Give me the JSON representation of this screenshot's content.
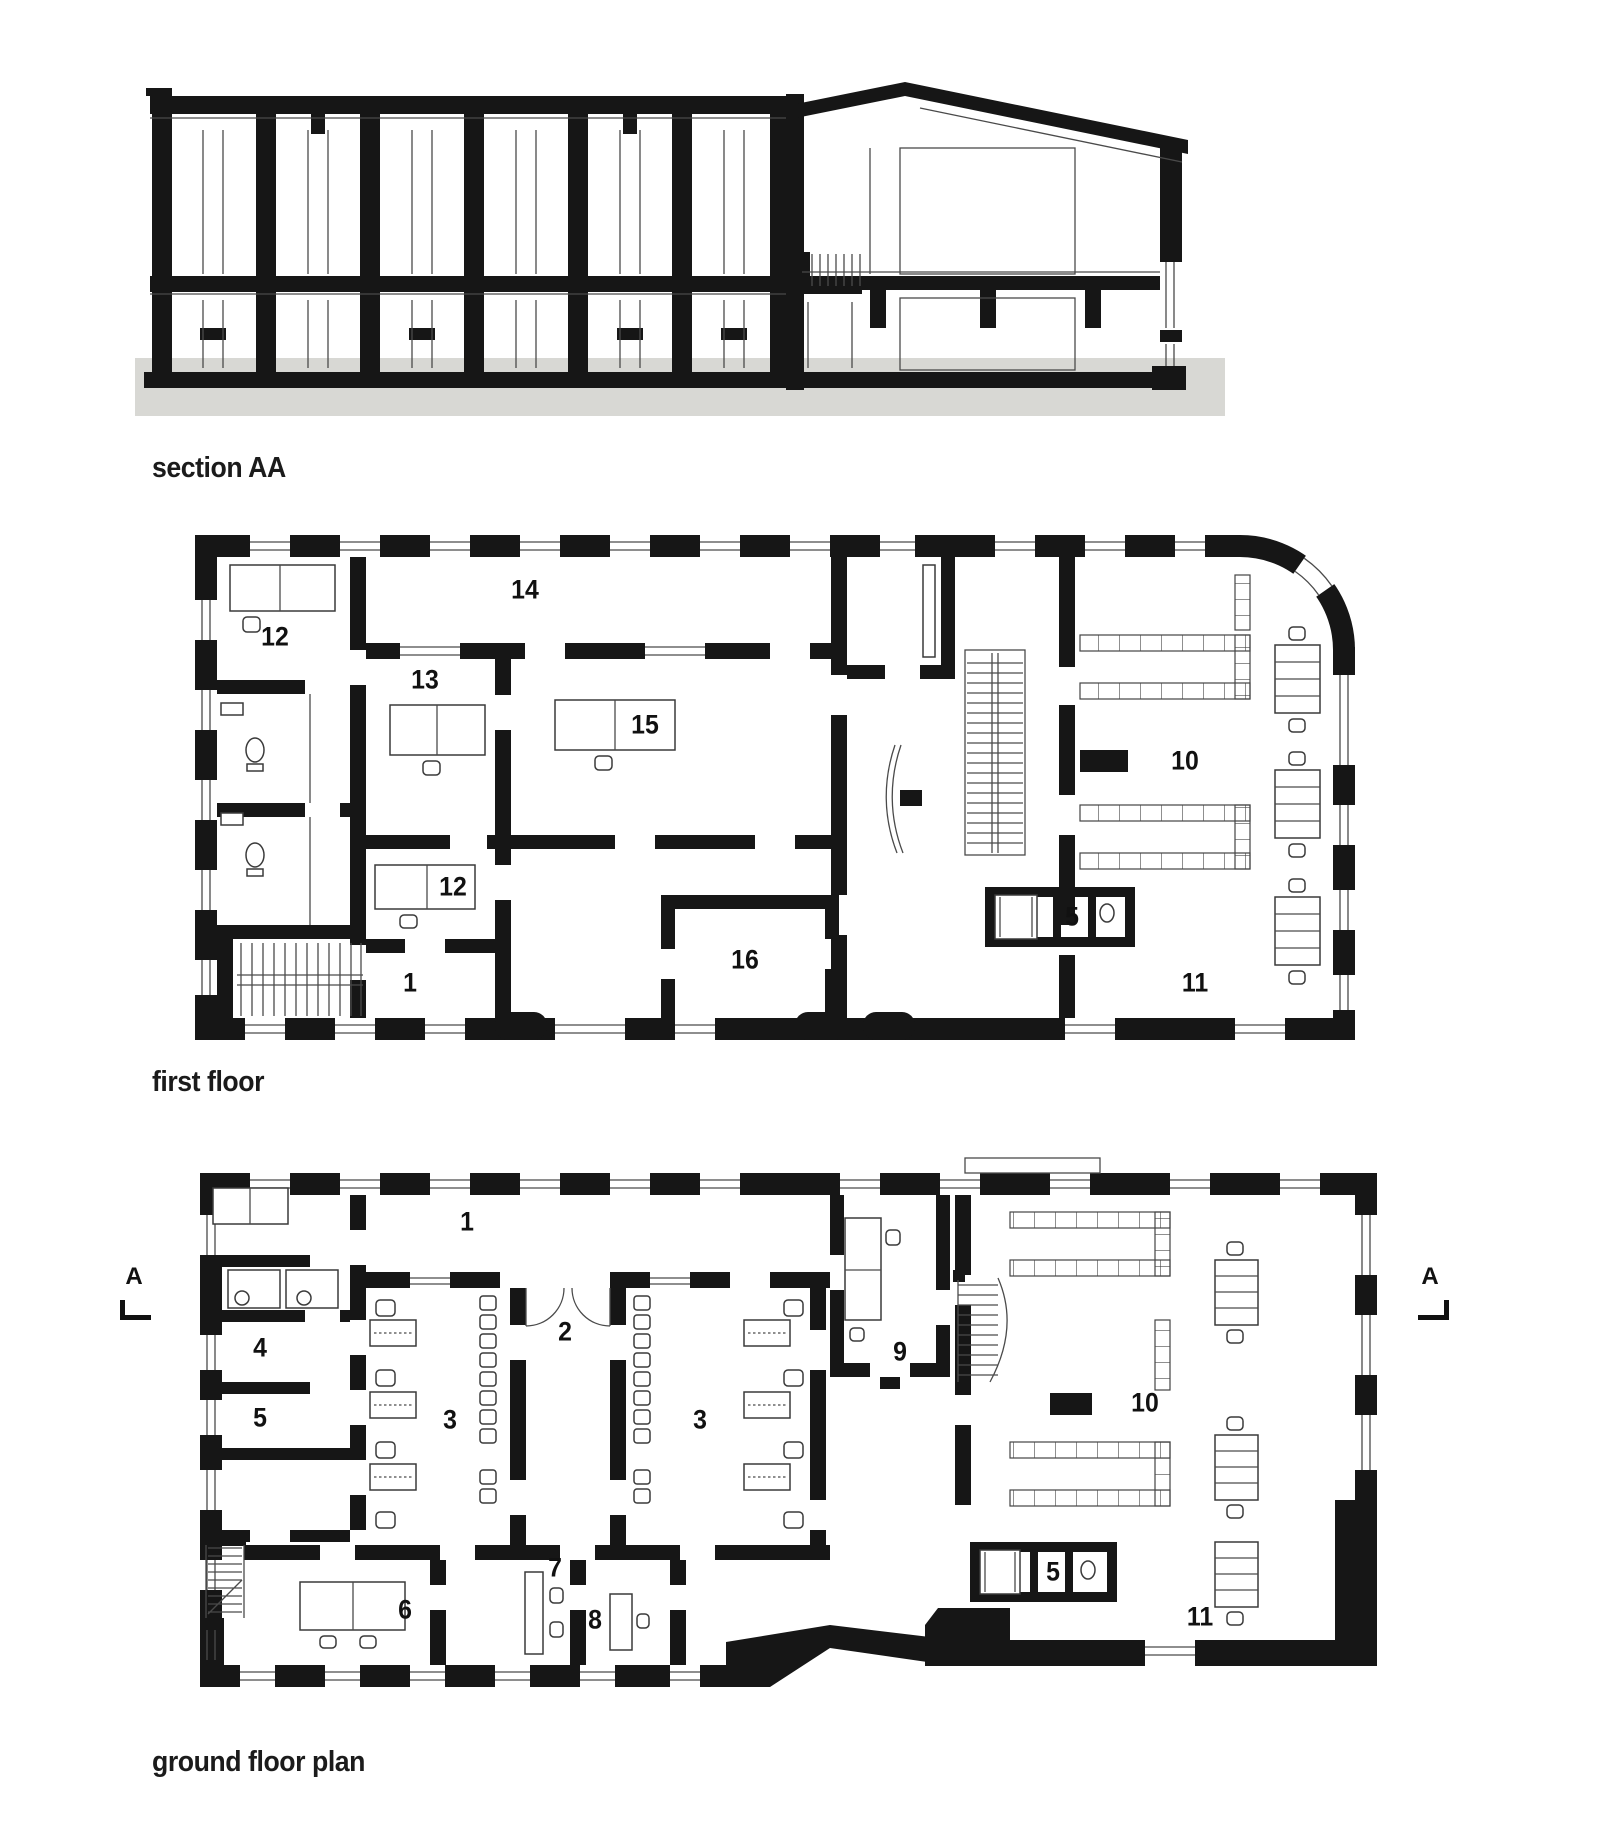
{
  "titles": {
    "section": "section AA",
    "first_floor": "first floor",
    "ground_floor": "ground floor plan"
  },
  "first_floor": {
    "labels": [
      "12",
      "13",
      "14",
      "15",
      "12",
      "1",
      "16",
      "5",
      "10",
      "11"
    ]
  },
  "ground_floor": {
    "labels": [
      "1",
      "2",
      "3",
      "3",
      "4",
      "5",
      "6",
      "7",
      "8",
      "9",
      "10",
      "11",
      "5"
    ],
    "marker_left": "A",
    "marker_right": "A"
  }
}
